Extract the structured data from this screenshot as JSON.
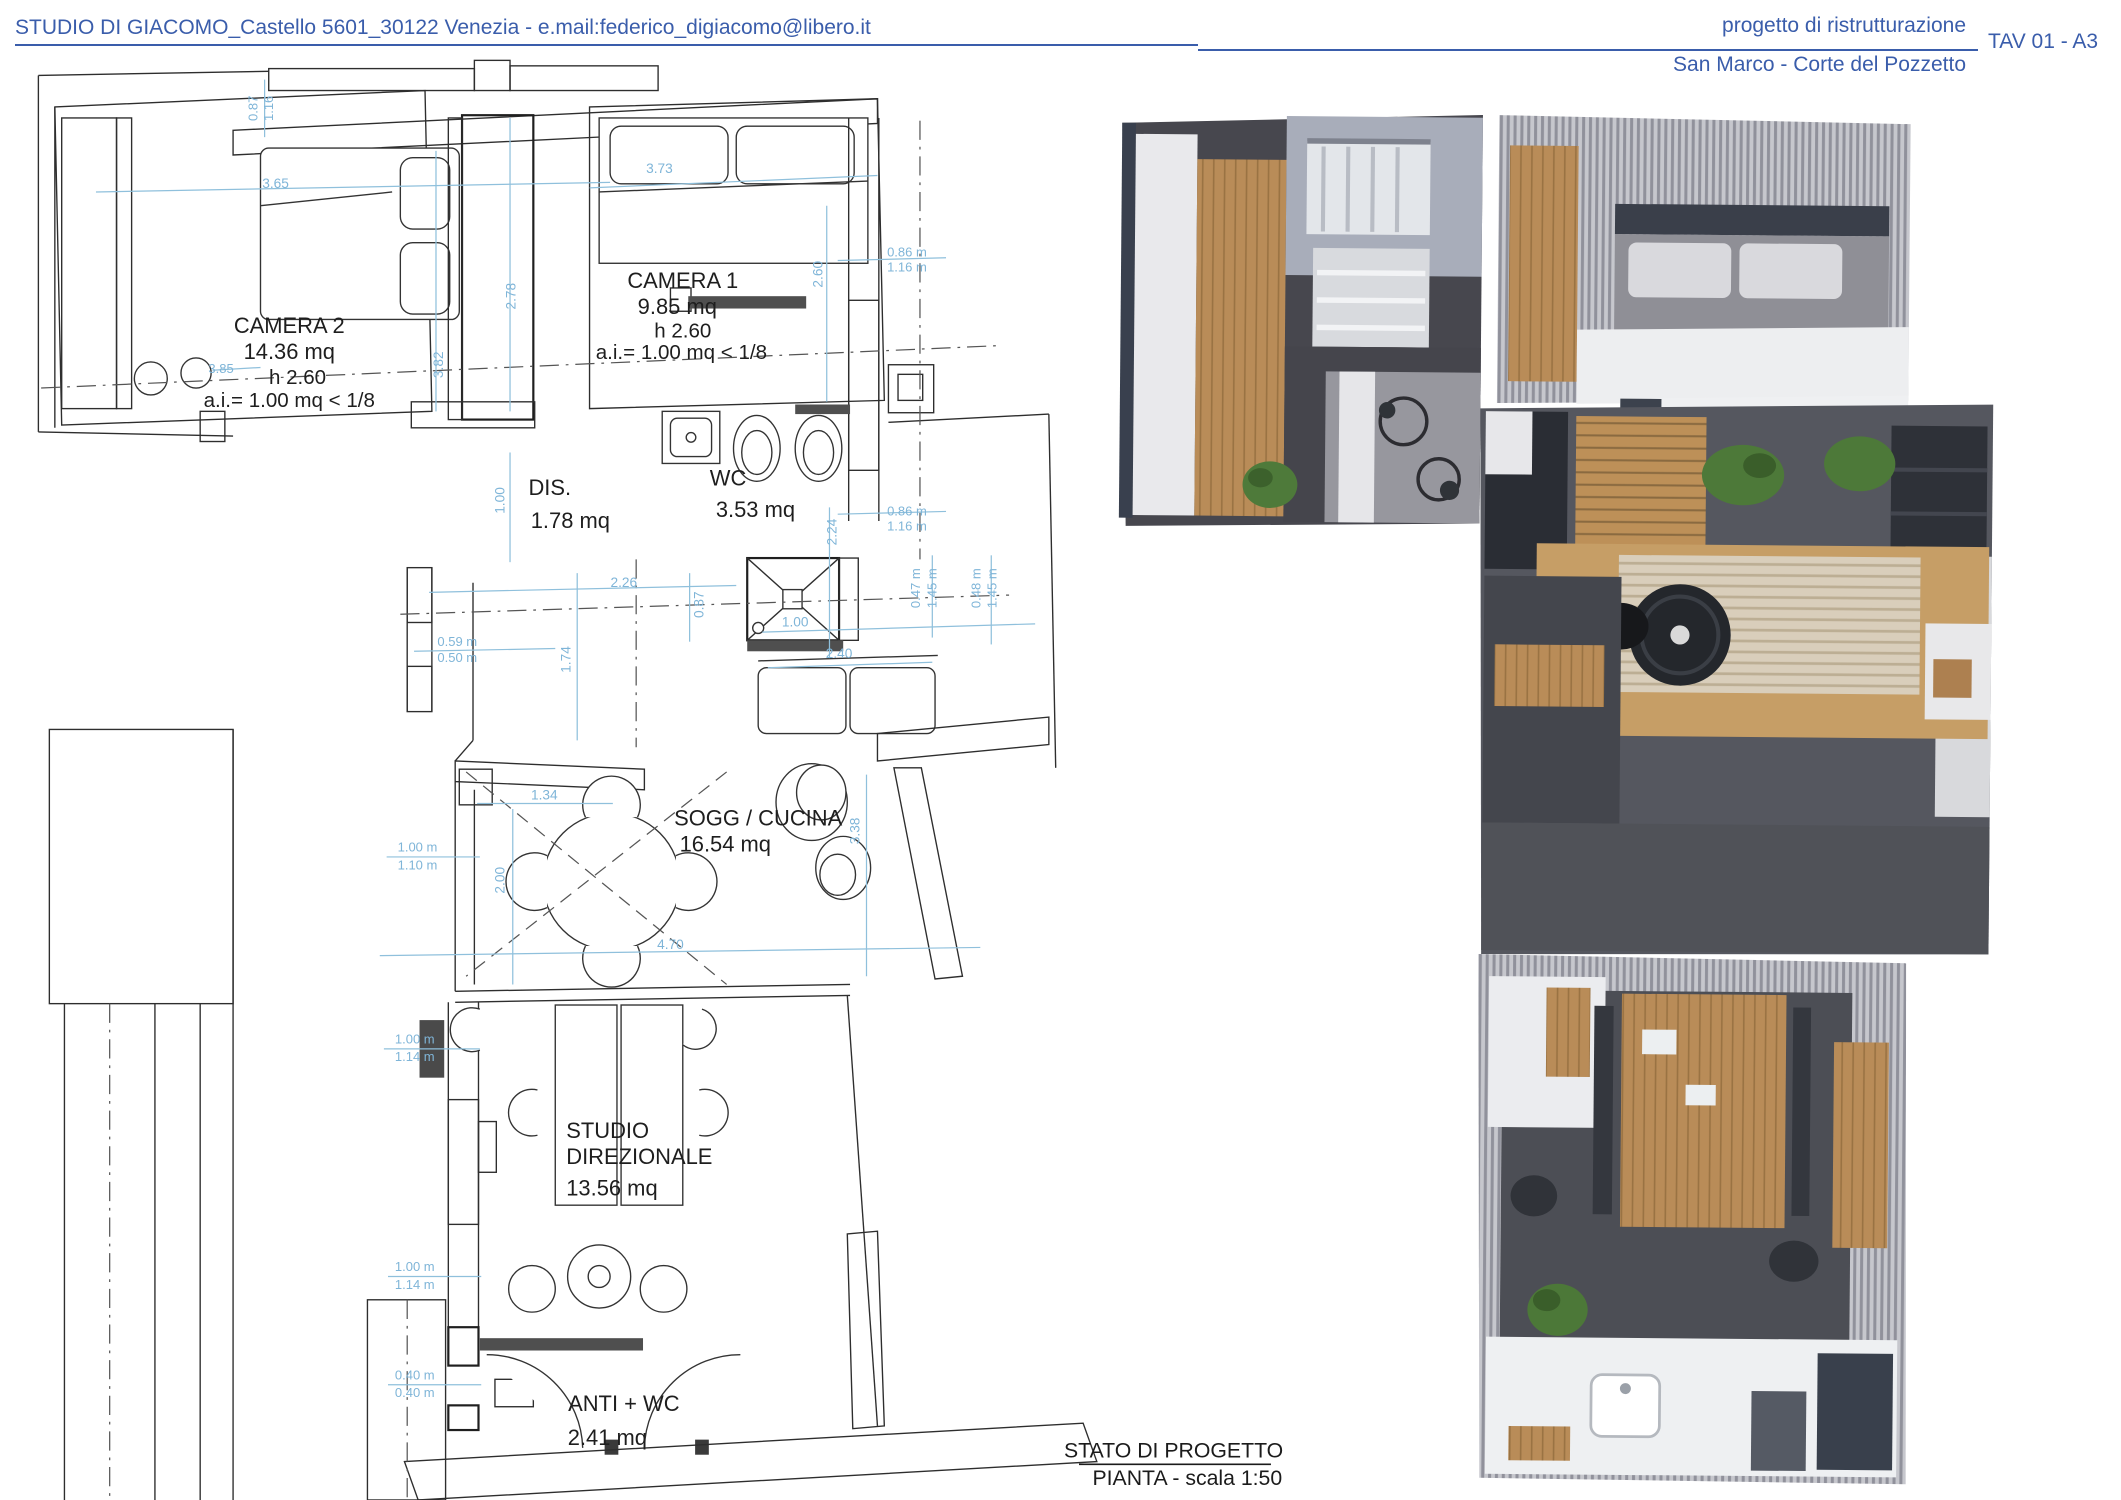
{
  "header": {
    "studio_line": "STUDIO DI GIACOMO_Castello 5601_30122 Venezia - e.mail:federico_digiacomo@libero.it",
    "project_line1": "progetto di ristrutturazione",
    "project_line2": "San Marco - Corte del Pozzetto",
    "sheet": "TAV 01 - A3"
  },
  "plan": {
    "rooms": {
      "camera2": {
        "name": "CAMERA 2",
        "area": "14.36 mq",
        "height": "h 2.60",
        "ai": "a.i.=  1.00 mq < 1/8"
      },
      "camera1": {
        "name": "CAMERA 1",
        "area": "9.85 mq",
        "height": "h 2.60",
        "ai": "a.i.= 1.00 mq < 1/8"
      },
      "dis": {
        "name": "DIS.",
        "area": "1.78 mq"
      },
      "wc": {
        "name": "WC",
        "area": "3.53  mq"
      },
      "sogg": {
        "name": "SOGG / CUCINA",
        "area": "16.54 mq"
      },
      "studio": {
        "name": "STUDIO",
        "name2": "DIREZIONALE",
        "area": "13.56 mq"
      },
      "anti": {
        "name": "ANTI + WC",
        "area": "2.41 mq"
      }
    },
    "dims": {
      "v365": "3.65",
      "v373": "3.73",
      "v087": "0.87",
      "v116": "1.16",
      "v278": "2.78",
      "v382": "3.82",
      "v385": "3.85",
      "v086m": "0.86 m",
      "v116m": "1.16 m",
      "v260": "2.60",
      "v224": "2.24",
      "v100": "1.00",
      "v226": "2.26",
      "v240": "2.40",
      "v047m": "0.47 m",
      "v048m": "0.48 m",
      "v145m": "1.45 m",
      "v059m": "0.59 m",
      "v050m": "0.50 m",
      "v174": "1.74",
      "v134": "1.34",
      "v200": "2.00",
      "v100m": "1.00 m",
      "v110m": "1.10 m",
      "v114m": "1.14 m",
      "v040m": "0.40 m",
      "v338": "3.38",
      "v470": "4.70"
    },
    "caption": {
      "line1": "STATO DI PROGETTO",
      "line2": "PIANTA - scala 1:50"
    }
  },
  "colors": {
    "header_blue": "#3a5dab",
    "dim_blue": "#7fb5d8",
    "plan_line": "#2e2e2e",
    "render_wall_dark": "#3a404c",
    "render_wall_stripe": "#c6c7cd",
    "render_floor_dark": "#47484f",
    "render_wood": "#b98c58",
    "render_plant_green": "#4e7a3a",
    "render_rug": "#d8cdb9",
    "render_bed_gray": "#97979e"
  }
}
